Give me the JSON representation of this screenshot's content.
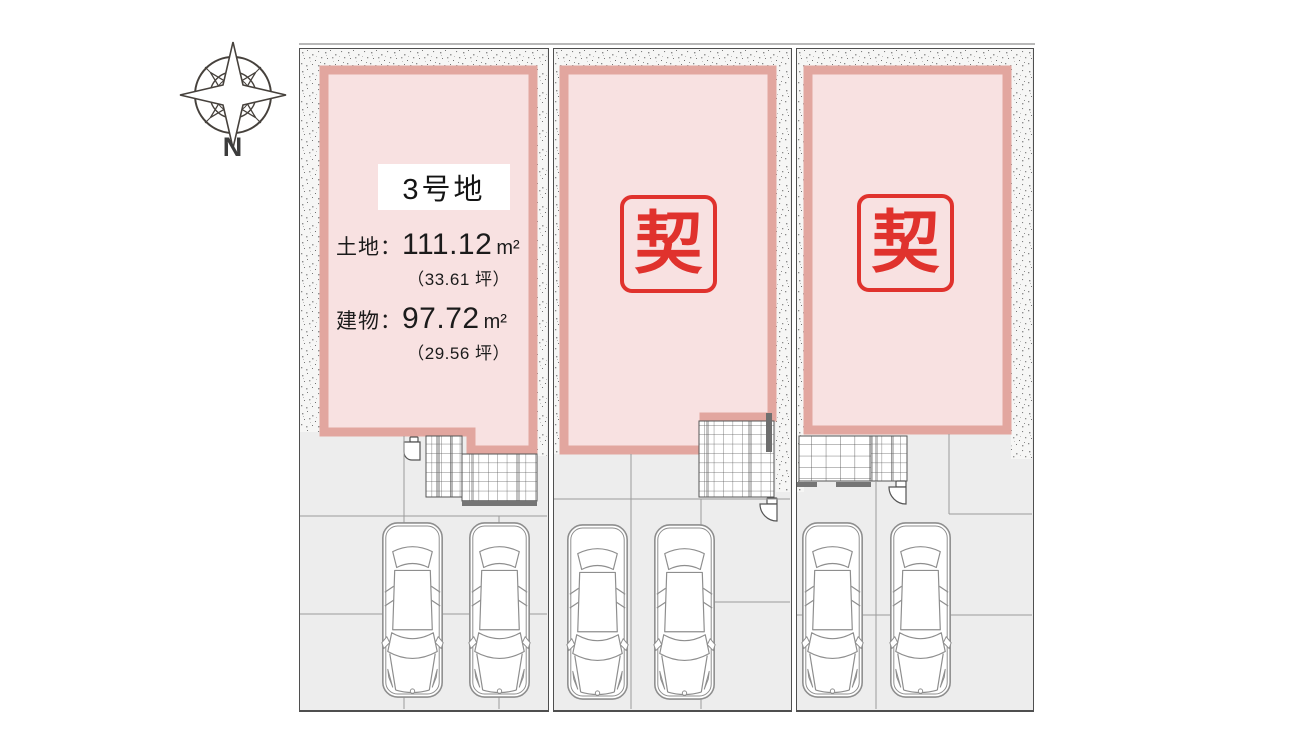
{
  "compass": {
    "label": "N"
  },
  "lots": [
    {
      "id": "lot-3",
      "name": "3号地",
      "land_label": "土地：",
      "land_value": "111.12",
      "land_unit": "m²",
      "land_tsubo": "（33.61 坪）",
      "building_label": "建物：",
      "building_value": "97.72",
      "building_unit": "m²",
      "building_tsubo": "（29.56 坪）"
    },
    {
      "id": "lot-middle",
      "stamp": "契"
    },
    {
      "id": "lot-right",
      "stamp": "契"
    }
  ],
  "colors": {
    "stamp_red": "#e0322d",
    "building_fill": "#f8e1e1",
    "building_border": "#e2a69f",
    "ground": "#ededed",
    "parcel_border": "#4f4f4f"
  }
}
